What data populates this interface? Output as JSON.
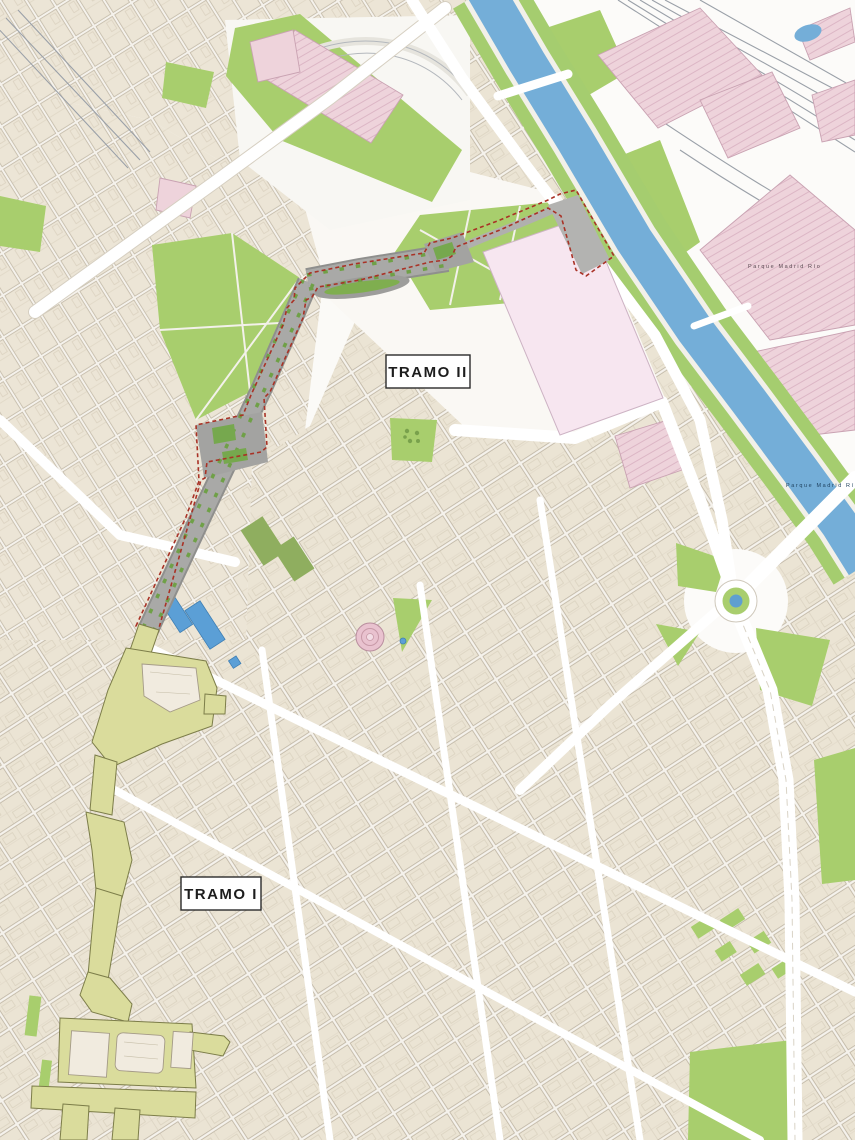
{
  "map": {
    "type": "urban-plan-map",
    "section_labels": [
      {
        "id": "tramo-ii",
        "text": "TRAMO II"
      },
      {
        "id": "tramo-i",
        "text": "TRAMO I"
      }
    ],
    "place_labels": [
      {
        "id": "parque-madrid-rio-north",
        "text": "Parque Madrid Río"
      },
      {
        "id": "parque-madrid-rio-river",
        "text": "Parque Madrid Río"
      }
    ],
    "palette": {
      "background": "#fbfaf7",
      "building_block": "#ebe4d4",
      "block_outline": "#bdb3a1",
      "park_green": "#a8ce6d",
      "tree_green": "#6fa047",
      "river_blue": "#74aed8",
      "pink_zone": "#eed3db",
      "pink_hatch": "#dcb6c5",
      "calderon_pink": "#f7e6f0",
      "tramo_i_olive": "#dadc9c",
      "tramo_i_outline": "#7c7d49",
      "tramo_ii_gray": "#a6a6a4",
      "boundary_red": "#a93226",
      "road_white": "#ffffff",
      "pool_blue": "#5b9fd6",
      "rail_gray": "#9aa0a8"
    }
  }
}
